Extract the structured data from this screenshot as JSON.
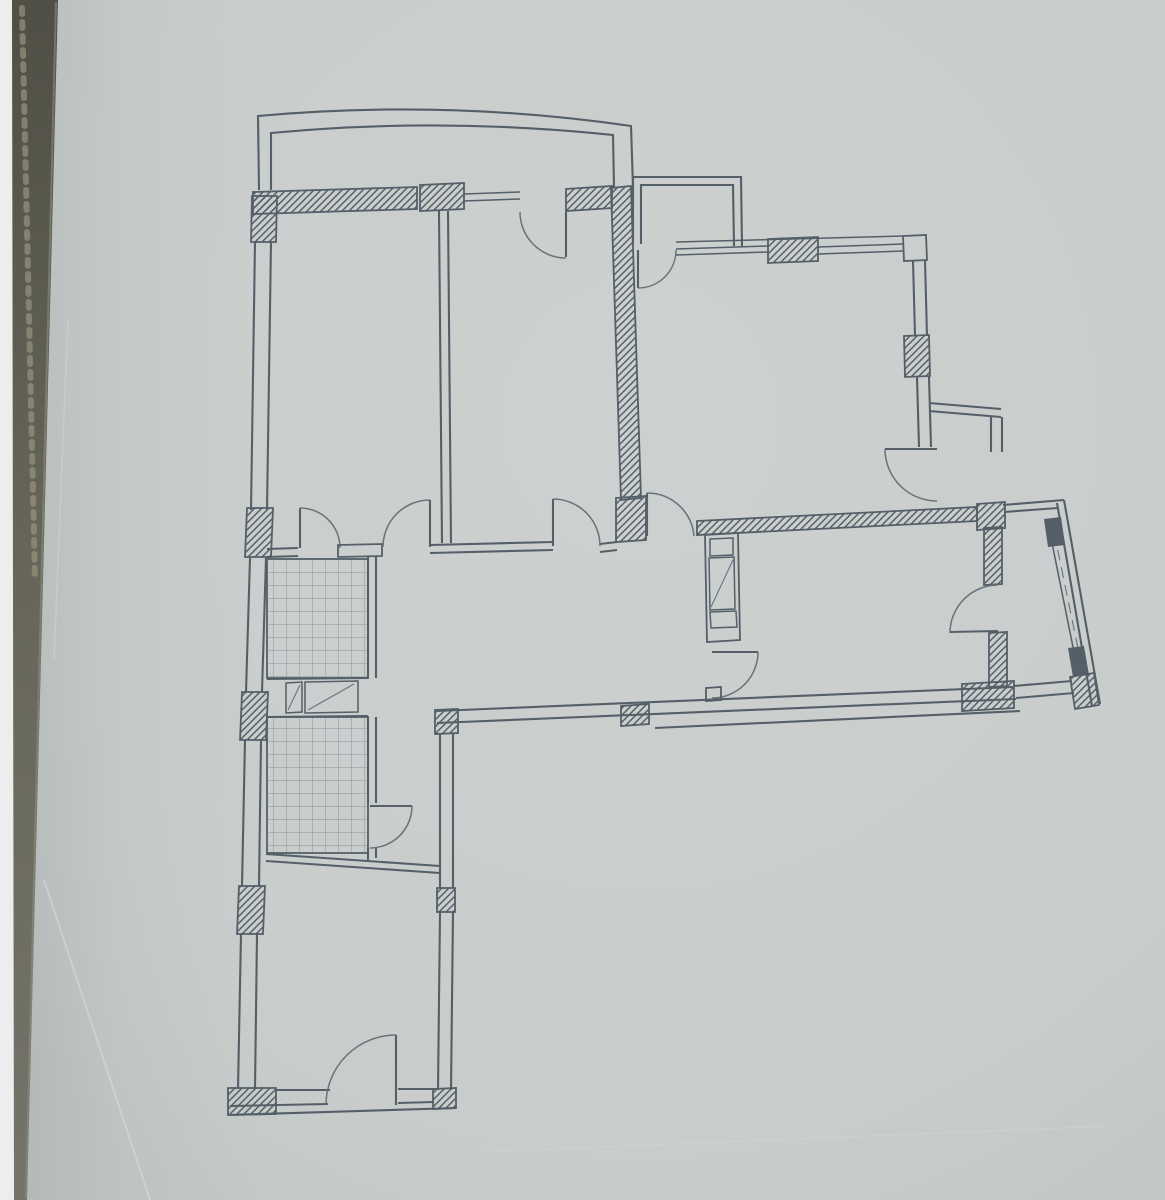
{
  "scene": {
    "description": "Photograph of an architectural apartment floor plan drawn on gray paper; dark photo edge strip on the left; no text labels visible",
    "canvas": {
      "width": 1165,
      "height": 1200
    },
    "colors": {
      "paper": "#c8cdcc",
      "ink": "#545f68",
      "ink_soft": "#67727a",
      "tile_grid": "#8a949b",
      "edge_dark": "#5e5d51",
      "edge_dark_bottom": "#75746a",
      "edge_white": "#ecedec",
      "crease": "#d8dddc"
    }
  },
  "floorplan": {
    "elements": [
      {
        "name": "paper-sheet",
        "tag": "rect",
        "attrs": {
          "x": 0,
          "y": 0,
          "width": 1165,
          "height": 1200,
          "fill": "#c8cdcc"
        }
      },
      {
        "name": "paper-light-sheen",
        "tag": "rect",
        "attrs": {
          "x": 0,
          "y": 0,
          "width": 1165,
          "height": 1200,
          "fill": "url(#paperLight)"
        }
      },
      {
        "name": "paper-left-shadow",
        "tag": "rect",
        "attrs": {
          "x": 0,
          "y": 0,
          "width": 260,
          "height": 1200,
          "fill": "url(#leftShade)"
        }
      },
      {
        "name": "paper-crease-1",
        "tag": "path",
        "attrs": {
          "d": "M 44,880 L 150,1200",
          "stroke": "#d8dddc",
          "stroke-width": "2",
          "fill": "none",
          "opacity": "0.55"
        }
      },
      {
        "name": "paper-crease-2",
        "tag": "path",
        "attrs": {
          "d": "M 68,320 L 54,660",
          "stroke": "#d2d7d6",
          "stroke-width": "1.6",
          "fill": "none",
          "opacity": "0.45"
        }
      },
      {
        "name": "paper-crease-3",
        "tag": "path",
        "attrs": {
          "d": "M 480,1152 L 1110,1126",
          "stroke": "#d3d8d7",
          "stroke-width": "1.4",
          "fill": "none",
          "opacity": "0.45"
        }
      },
      {
        "name": "balcony-top-rail-outer",
        "tag": "path",
        "attrs": {
          "class": "w2",
          "d": "M 259,190 L 258,116 Q 445,99 631,126 L 633,187"
        }
      },
      {
        "name": "balcony-top-rail-inner",
        "tag": "path",
        "attrs": {
          "class": "w2",
          "d": "M 271,190 L 271,133 Q 440,117 613,135 L 614,187"
        }
      },
      {
        "name": "niche-balcony-rail-outer",
        "tag": "path",
        "attrs": {
          "class": "w2",
          "d": "M 633,244 L 633,177 L 741,177 L 742,246"
        }
      },
      {
        "name": "niche-balcony-rail-inner",
        "tag": "path",
        "attrs": {
          "class": "w2",
          "d": "M 641,244 L 641,185 L 733,185 L 734,246"
        }
      },
      {
        "name": "north-wall-hatch-west",
        "tag": "polygon",
        "attrs": {
          "class": "hatch",
          "points": "253,192 417,187 417,209 253,214"
        }
      },
      {
        "name": "north-wall-pier-hatch",
        "tag": "polygon",
        "attrs": {
          "class": "hatch",
          "points": "420,185 464,183 464,209 420,211"
        }
      },
      {
        "name": "north-wall-hatch-east",
        "tag": "polygon",
        "attrs": {
          "class": "hatch",
          "points": "566,189 612,186 612,208 566,211"
        }
      },
      {
        "name": "north-window-lines-room2",
        "tag": "path",
        "attrs": {
          "class": "w15",
          "d": "M 464,194 L 520,192 M 464,201 L 520,199"
        }
      },
      {
        "name": "balcony-door-leaf",
        "tag": "path",
        "attrs": {
          "class": "w2",
          "d": "M 566,212 L 566,257"
        }
      },
      {
        "name": "balcony-door-swing-arc",
        "tag": "path",
        "attrs": {
          "class": "arc",
          "d": "M 520,212 A 46 46 0 0 0 566,258"
        }
      },
      {
        "name": "west-wall-lines",
        "tag": "path",
        "attrs": {
          "class": "w2",
          "d": "M 255,242 L 251,510 M 271,242 L 267,510 M 250,558 L 246,692 M 266,558 L 262,692 M 245,740 L 242,886 M 261,740 L 259,886 M 241,934 L 238,1089 M 257,934 L 255,1089"
        }
      },
      {
        "name": "west-wall-column-top",
        "tag": "polygon",
        "attrs": {
          "class": "hatch",
          "points": "252,196 277,196 276,242 251,242"
        }
      },
      {
        "name": "west-wall-column-2",
        "tag": "polygon",
        "attrs": {
          "class": "hatch",
          "points": "247,508 273,508 271,557 245,557"
        }
      },
      {
        "name": "west-wall-column-3",
        "tag": "polygon",
        "attrs": {
          "class": "hatch",
          "points": "242,692 268,692 266,740 240,740"
        }
      },
      {
        "name": "west-wall-column-4",
        "tag": "polygon",
        "attrs": {
          "class": "hatch",
          "points": "239,886 265,886 263,934 237,934"
        }
      },
      {
        "name": "bedroom-divider-wall",
        "tag": "path",
        "attrs": {
          "class": "w2",
          "d": "M 439,211 L 442,543 M 448,211 L 451,543"
        }
      },
      {
        "name": "center-wall-hatch",
        "tag": "polygon",
        "attrs": {
          "class": "hatch",
          "points": "611,188 631,186 641,498 621,500"
        }
      },
      {
        "name": "center-wall-end-block",
        "tag": "polygon",
        "attrs": {
          "class": "hatch",
          "points": "616,498 646,496 646,540 616,542"
        }
      },
      {
        "name": "rooms-south-wall-lines",
        "tag": "path",
        "attrs": {
          "class": "w2",
          "d": "M 267,549 L 298,548 M 267,557 L 298,556 M 430,545 L 553,542 M 430,553 L 553,550 M 600,544 L 617,542 M 600,552 L 617,550"
        }
      },
      {
        "name": "bathroom1-door-leaf",
        "tag": "path",
        "attrs": {
          "class": "w2",
          "d": "M 300,548 L 300,508"
        }
      },
      {
        "name": "bathroom1-door-swing-arc",
        "tag": "path",
        "attrs": {
          "class": "arc",
          "d": "M 300,508 A 40 40 0 0 1 340,548"
        }
      },
      {
        "name": "bathroom1-north-wall-cap",
        "tag": "polygon",
        "attrs": {
          "class": "outline",
          "points": "338,545 382,544 382,556 338,557"
        }
      },
      {
        "name": "bedroom1-door-leaf",
        "tag": "path",
        "attrs": {
          "class": "w2",
          "d": "M 430,547 L 430,500"
        }
      },
      {
        "name": "bedroom1-door-swing-arc",
        "tag": "path",
        "attrs": {
          "class": "arc",
          "d": "M 430,500 A 47 47 0 0 0 383,547"
        }
      },
      {
        "name": "bedroom2-door-leaf",
        "tag": "path",
        "attrs": {
          "class": "w2",
          "d": "M 553,546 L 553,499"
        }
      },
      {
        "name": "bedroom2-door-swing-arc",
        "tag": "path",
        "attrs": {
          "class": "arc",
          "d": "M 553,499 A 47 47 0 0 1 600,546"
        }
      },
      {
        "name": "living-room-door-leaf",
        "tag": "path",
        "attrs": {
          "class": "w2",
          "d": "M 647,536 L 647,493"
        }
      },
      {
        "name": "living-room-door-swing-arc",
        "tag": "path",
        "attrs": {
          "class": "arc",
          "d": "M 647,493 A 47 47 0 0 1 694,536"
        }
      },
      {
        "name": "niche-door-leaf",
        "tag": "path",
        "attrs": {
          "class": "w2",
          "d": "M 638,250 L 638,288"
        }
      },
      {
        "name": "niche-door-swing-arc",
        "tag": "path",
        "attrs": {
          "class": "arc",
          "d": "M 638,288 A 38 38 0 0 0 676,250"
        }
      },
      {
        "name": "north-window-top-edge",
        "tag": "path",
        "attrs": {
          "class": "w15",
          "d": "M 676,242 L 903,236"
        }
      },
      {
        "name": "north-window-lines-living",
        "tag": "path",
        "attrs": {
          "class": "w15",
          "d": "M 676,249 L 768,246 M 676,255 L 768,252 M 818,247 L 903,244 M 818,254 L 903,251"
        }
      },
      {
        "name": "north-wall-pier-hatch-east",
        "tag": "polygon",
        "attrs": {
          "class": "hatch",
          "points": "768,239 818,237 818,261 768,263"
        }
      },
      {
        "name": "northeast-corner-block",
        "tag": "polygon",
        "attrs": {
          "class": "outline",
          "points": "903,236 926,235 927,260 904,261"
        }
      },
      {
        "name": "east-window-wall-lines",
        "tag": "path",
        "attrs": {
          "class": "w2",
          "d": "M 913,261 L 915,336 M 925,261 L 927,336 M 917,377 L 919,447 M 929,377 L 931,447"
        }
      },
      {
        "name": "east-wall-column",
        "tag": "polygon",
        "attrs": {
          "class": "hatch",
          "points": "904,336 929,335 930,376 905,377"
        }
      },
      {
        "name": "east-step-lines",
        "tag": "path",
        "attrs": {
          "class": "w2",
          "d": "M 929,403 L 1001,409 M 929,411 L 1001,417 M 991,417 L 991,452 M 1002,417 L 1002,452"
        }
      },
      {
        "name": "living-balcony-door-leaf",
        "tag": "path",
        "attrs": {
          "class": "w2",
          "d": "M 885,449 L 937,449"
        }
      },
      {
        "name": "living-balcony-door-swing-arc",
        "tag": "path",
        "attrs": {
          "class": "arc",
          "d": "M 885,449 A 52 52 0 0 0 937,501"
        }
      },
      {
        "name": "southeast-corner-column",
        "tag": "polygon",
        "attrs": {
          "class": "hatch",
          "points": "977,504 1005,502 1005,528 977,530"
        }
      },
      {
        "name": "mid-south-wall-hatch",
        "tag": "polygon",
        "attrs": {
          "class": "hatch",
          "points": "697,521 977,507 977,521 697,535"
        }
      },
      {
        "name": "vent-shaft-outline",
        "tag": "polygon",
        "attrs": {
          "class": "outline",
          "points": "705,535 738,533 740,640 707,642"
        }
      },
      {
        "name": "vent-shaft-compartments",
        "tag": "path",
        "attrs": {
          "class": "w15",
          "d": "M 710,539 L 733,538 L 733,555 L 710,556 Z M 709,558 L 734,557 L 735,609 L 710,610 Z M 710,612 L 736,611 L 737,627 L 711,628 Z"
        }
      },
      {
        "name": "vent-shaft-diagonal",
        "tag": "path",
        "attrs": {
          "class": "thin",
          "d": "M 711,607 L 733,560"
        }
      },
      {
        "name": "hall-kitchen-door-leaf",
        "tag": "path",
        "attrs": {
          "class": "w2",
          "d": "M 712,652 L 758,652"
        }
      },
      {
        "name": "hall-kitchen-door-swing-arc",
        "tag": "path",
        "attrs": {
          "class": "arc",
          "d": "M 758,652 A 46 46 0 0 1 712,698"
        }
      },
      {
        "name": "hall-door-jamb-stub",
        "tag": "polygon",
        "attrs": {
          "class": "outline",
          "points": "706,688 721,687 721,700 706,701"
        }
      },
      {
        "name": "south-exterior-wall-lines",
        "tag": "path",
        "attrs": {
          "class": "w2",
          "d": "M 437,711 L 1014,687 M 437,723 L 1016,699 M 655,728 L 1020,711"
        }
      },
      {
        "name": "south-wall-block-west",
        "tag": "polygon",
        "attrs": {
          "class": "hatch",
          "points": "435,710 458,709 458,733 435,734"
        }
      },
      {
        "name": "south-wall-block-mid",
        "tag": "polygon",
        "attrs": {
          "class": "hatch",
          "points": "621,706 649,704 649,724 621,726"
        }
      },
      {
        "name": "south-wall-block-east",
        "tag": "polygon",
        "attrs": {
          "class": "hatch",
          "points": "962,684 1014,681 1014,708 962,711"
        }
      },
      {
        "name": "wing-east-wall-lines",
        "tag": "path",
        "attrs": {
          "class": "w2",
          "d": "M 440,733 L 440,888 M 453,733 L 453,888 M 440,912 L 438,1090 M 453,912 L 451,1090"
        }
      },
      {
        "name": "wing-east-wall-block",
        "tag": "polygon",
        "attrs": {
          "class": "hatch",
          "points": "437,888 455,888 455,912 437,912"
        }
      },
      {
        "name": "wing-se-corner-block",
        "tag": "polygon",
        "attrs": {
          "class": "hatch",
          "points": "433,1089 456,1088 456,1108 433,1109"
        }
      },
      {
        "name": "wing-sw-corner-block",
        "tag": "polygon",
        "attrs": {
          "class": "hatch",
          "points": "228,1088 276,1088 276,1114 228,1115"
        }
      },
      {
        "name": "wing-south-wall-lines",
        "tag": "path",
        "attrs": {
          "class": "w2",
          "d": "M 275,1090 L 330,1090 M 398,1089 L 434,1089 M 230,1106 L 328,1104 M 398,1103 L 434,1102 M 228,1115 L 456,1108"
        }
      },
      {
        "name": "entry-door-leaf",
        "tag": "path",
        "attrs": {
          "class": "w2",
          "d": "M 396,1105 L 396,1035"
        }
      },
      {
        "name": "entry-door-swing-arc",
        "tag": "path",
        "attrs": {
          "class": "arc",
          "d": "M 396,1035 A 70 70 0 0 0 326,1105"
        }
      },
      {
        "name": "bathroom1-east-wall",
        "tag": "path",
        "attrs": {
          "class": "w2",
          "d": "M 368,557 L 368,678 M 376,557 L 376,678"
        }
      },
      {
        "name": "bathroom1-tile-floor",
        "tag": "rect",
        "attrs": {
          "class": "tile",
          "x": 267,
          "y": 559,
          "width": 101,
          "height": 119
        }
      },
      {
        "name": "bathroom1-south-edge",
        "tag": "path",
        "attrs": {
          "class": "w2",
          "d": "M 267,679 L 368,678"
        }
      },
      {
        "name": "vent-box-small",
        "tag": "polygon",
        "attrs": {
          "class": "w15",
          "points": "286,683 302,682 302,712 286,713",
          "fill": "none"
        }
      },
      {
        "name": "vent-box-small-diagonal",
        "tag": "path",
        "attrs": {
          "class": "thin",
          "d": "M 288,710 L 300,685"
        }
      },
      {
        "name": "vent-box-large",
        "tag": "polygon",
        "attrs": {
          "class": "w15",
          "points": "305,682 358,681 358,712 305,713",
          "fill": "none"
        }
      },
      {
        "name": "vent-box-large-diagonal",
        "tag": "path",
        "attrs": {
          "class": "thin",
          "d": "M 308,710 L 354,684"
        }
      },
      {
        "name": "vent-band-south-edge",
        "tag": "path",
        "attrs": {
          "class": "w2",
          "d": "M 267,717 L 368,716"
        }
      },
      {
        "name": "bathroom2-tile-floor",
        "tag": "rect",
        "attrs": {
          "class": "tile",
          "x": 267,
          "y": 717,
          "width": 101,
          "height": 136
        }
      },
      {
        "name": "bathroom2-east-wall",
        "tag": "path",
        "attrs": {
          "class": "w2",
          "d": "M 368,717 L 368,803 M 376,717 L 376,803 M 368,848 L 368,860 M 376,848 L 376,858"
        }
      },
      {
        "name": "bathroom2-door-leaf",
        "tag": "path",
        "attrs": {
          "class": "w2",
          "d": "M 370,806 L 412,806"
        }
      },
      {
        "name": "bathroom2-door-swing-arc",
        "tag": "path",
        "attrs": {
          "class": "arc",
          "d": "M 412,806 A 42 42 0 0 1 370,848"
        }
      },
      {
        "name": "bathroom2-south-wall",
        "tag": "path",
        "attrs": {
          "class": "w2",
          "d": "M 266,854 L 440,866 M 266,861 L 440,873"
        }
      },
      {
        "name": "bay-top-edge",
        "tag": "path",
        "attrs": {
          "class": "w2",
          "d": "M 1003,505 L 1064,500 M 1004,512 L 1058,508"
        }
      },
      {
        "name": "bay-east-wall",
        "tag": "path",
        "attrs": {
          "class": "w2",
          "d": "M 1064,500 L 1100,704 M 1057,503 L 1092,706"
        }
      },
      {
        "name": "bay-window-sill",
        "tag": "path",
        "attrs": {
          "class": "w15",
          "d": "M 1049,528 L 1077,667"
        }
      },
      {
        "name": "bay-window-glazing",
        "tag": "path",
        "attrs": {
          "class": "thin dashed",
          "d": "M 1054,532 L 1081,663"
        }
      },
      {
        "name": "bay-window-cap-north",
        "tag": "polygon",
        "attrs": {
          "class": "solid",
          "points": "1044,519 1061,517 1065,545 1048,547"
        }
      },
      {
        "name": "bay-window-cap-south",
        "tag": "polygon",
        "attrs": {
          "class": "solid",
          "points": "1068,648 1084,646 1089,675 1073,677"
        }
      },
      {
        "name": "bay-se-corner-block",
        "tag": "polygon",
        "attrs": {
          "class": "hatch",
          "points": "1070,677 1094,673 1099,705 1075,709"
        }
      },
      {
        "name": "bay-south-edge",
        "tag": "path",
        "attrs": {
          "class": "w2",
          "d": "M 1014,686 L 1072,681 M 1016,698 L 1074,693"
        }
      },
      {
        "name": "room-bay-wall-hatch-north",
        "tag": "polygon",
        "attrs": {
          "class": "hatch",
          "points": "984,528 1002,527 1002,584 984,585"
        }
      },
      {
        "name": "room-bay-wall-hatch-south",
        "tag": "polygon",
        "attrs": {
          "class": "hatch",
          "points": "989,633 1007,632 1007,686 989,687"
        }
      },
      {
        "name": "bay-door-leaf",
        "tag": "path",
        "attrs": {
          "class": "w2",
          "d": "M 950,632 L 998,631"
        }
      },
      {
        "name": "bay-door-swing-arc",
        "tag": "path",
        "attrs": {
          "class": "arc",
          "d": "M 950,633 A 48 48 0 0 1 998,585"
        }
      },
      {
        "name": "photo-edge-white-strip",
        "tag": "polygon",
        "attrs": {
          "points": "0,0 14,0 16,1200 0,1200",
          "fill": "#ecedec"
        }
      },
      {
        "name": "photo-edge-dark-strip",
        "tag": "polygon",
        "attrs": {
          "points": "12,0 58,0 27,1200 14,1200",
          "fill": "url(#edgeGrad)"
        }
      },
      {
        "name": "photo-edge-binding-texture",
        "tag": "path",
        "attrs": {
          "class": "dotted",
          "d": "M 22,8 L 35,580",
          "stroke": "#96937f",
          "stroke-width": "6",
          "fill": "none",
          "opacity": "0.7"
        }
      },
      {
        "name": "photo-edge-highlight",
        "tag": "path",
        "attrs": {
          "d": "M 56,2 L 26,1198",
          "stroke": "#8e8d80",
          "stroke-width": "2",
          "fill": "none",
          "opacity": "0.6"
        }
      }
    ]
  }
}
